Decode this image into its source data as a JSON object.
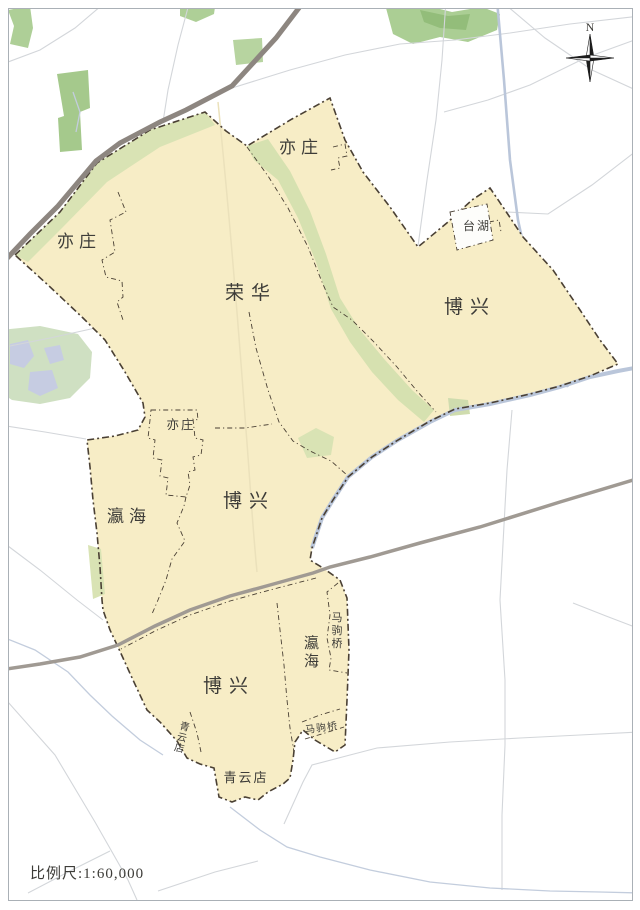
{
  "map": {
    "description": "Administrative district map of Beijing Yizhuang development area, yellow district polygon with dash-dot boundaries over a light road basemap",
    "compass": {
      "north_label": "N"
    },
    "scale": {
      "text": "比例尺:1:60,000"
    },
    "region_labels": [
      {
        "id": "yizhuang-ne",
        "text": "亦庄"
      },
      {
        "id": "yizhuang-west",
        "text": "亦庄"
      },
      {
        "id": "ronghua",
        "text": "荣华"
      },
      {
        "id": "boxing-east",
        "text": "博兴"
      },
      {
        "id": "taihu",
        "text": "台湖"
      },
      {
        "id": "yizhuang-center",
        "text": "亦庄"
      },
      {
        "id": "yinghai-west",
        "text": "瀛海"
      },
      {
        "id": "boxing-center",
        "text": "博兴"
      },
      {
        "id": "yinghai-se",
        "text": "瀛海"
      },
      {
        "id": "majuqiao-vertical",
        "text": "马驹桥"
      },
      {
        "id": "boxing-south",
        "text": "博兴"
      },
      {
        "id": "majuqiao-small",
        "text": "马驹桥"
      },
      {
        "id": "qingyundian-west",
        "text": "青云店"
      },
      {
        "id": "qingyundian",
        "text": "青云店"
      }
    ],
    "colors": {
      "district_fill": "#f7edc6",
      "greenbelt": "#d9e3b4",
      "forest": "#aecf97",
      "park": "#cfe0c2",
      "lake": "#c6cce2",
      "water": "#bac6da",
      "highway_dark": "#8d8680",
      "highway_light": "#a09a93",
      "road": "#d3d6da",
      "boundary": "#4a4034",
      "label_text": "#3d3c38",
      "frame": "#aab0b6"
    }
  }
}
